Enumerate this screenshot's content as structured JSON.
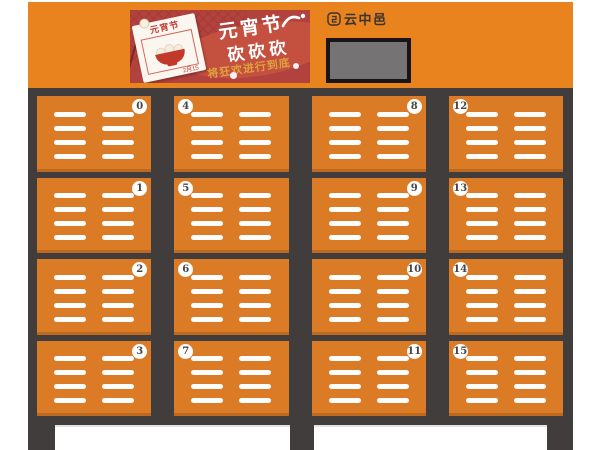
{
  "brand": {
    "name": "云中邑"
  },
  "poster": {
    "calendar_title": "元宵节",
    "calendar_date": "2月15",
    "headline": "元宵节",
    "headline2": "砍砍砍",
    "subline": "将狂欢进行到底"
  },
  "colors": {
    "header-orange": "#e8831d",
    "door-orange": "#dc7b26",
    "frame-dark": "#413d3c",
    "poster-red": "#b2423e",
    "poster-blob": "#c4503f",
    "gold": "#dfa23d",
    "screen-face": "#767374"
  },
  "lockers": {
    "doors": [
      {
        "number": "0",
        "badge": "right"
      },
      {
        "number": "4",
        "badge": "left"
      },
      {
        "number": "8",
        "badge": "right"
      },
      {
        "number": "12",
        "badge": "left"
      },
      {
        "number": "1",
        "badge": "right"
      },
      {
        "number": "5",
        "badge": "left"
      },
      {
        "number": "9",
        "badge": "right"
      },
      {
        "number": "13",
        "badge": "left"
      },
      {
        "number": "2",
        "badge": "right"
      },
      {
        "number": "6",
        "badge": "left"
      },
      {
        "number": "10",
        "badge": "right"
      },
      {
        "number": "14",
        "badge": "left"
      },
      {
        "number": "3",
        "badge": "right"
      },
      {
        "number": "7",
        "badge": "left"
      },
      {
        "number": "11",
        "badge": "right"
      },
      {
        "number": "15",
        "badge": "left"
      }
    ]
  }
}
